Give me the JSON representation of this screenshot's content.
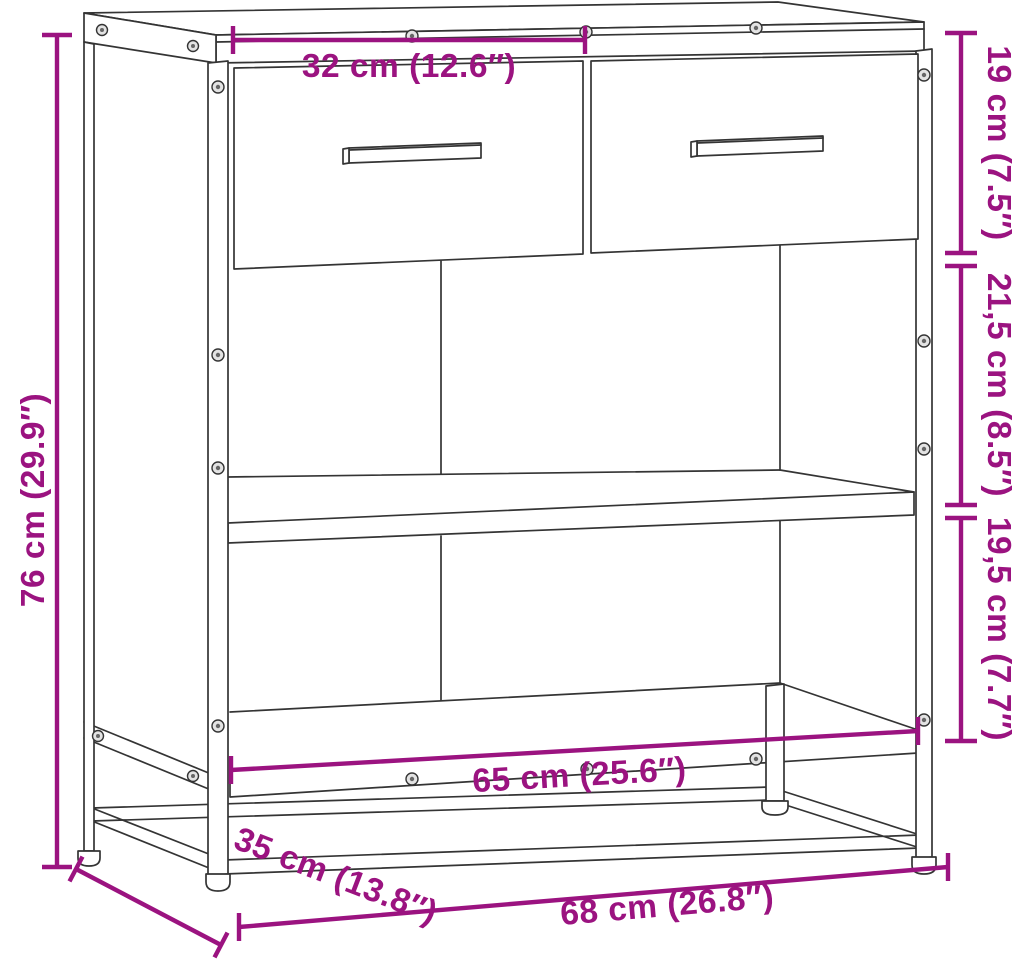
{
  "diagram": {
    "accent_color": "#9B1380",
    "line_color": "#343434",
    "background_color": "#FFFFFF",
    "dimensions": {
      "drawer_width": "32 cm (12.6″)",
      "drawer_height": "19 cm (7.5″)",
      "upper_compartment_height": "21,5 cm (8.5″)",
      "lower_compartment_height": "19,5 cm (7.7″)",
      "total_height": "76 cm (29.9″)",
      "shelf_width": "65 cm (25.6″)",
      "depth": "35 cm (13.8″)",
      "total_width": "68 cm (26.8″)"
    }
  }
}
